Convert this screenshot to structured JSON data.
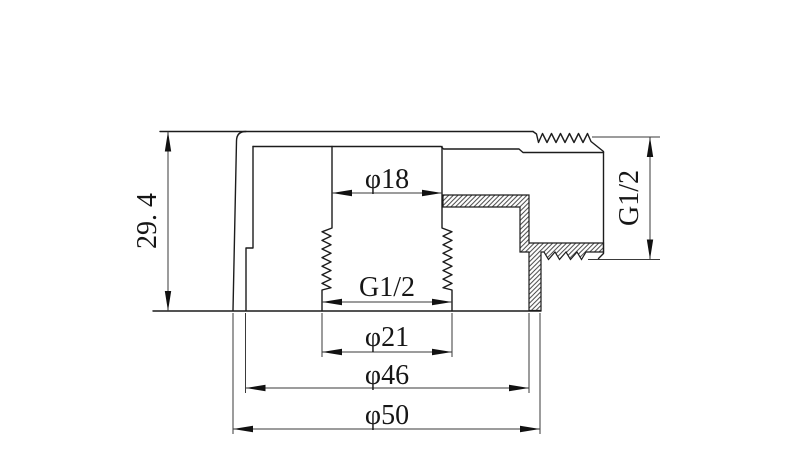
{
  "colors": {
    "line": "#1c1c1c",
    "background": "#ffffff"
  },
  "dimensions": {
    "overall_height": "29. 4",
    "top_bore_diameter": "φ18",
    "internal_thread": "G1/2",
    "counterbore_diameter": "φ21",
    "inner_step_diameter": "φ46",
    "outer_diameter": "φ50",
    "side_thread": "G1/2"
  }
}
